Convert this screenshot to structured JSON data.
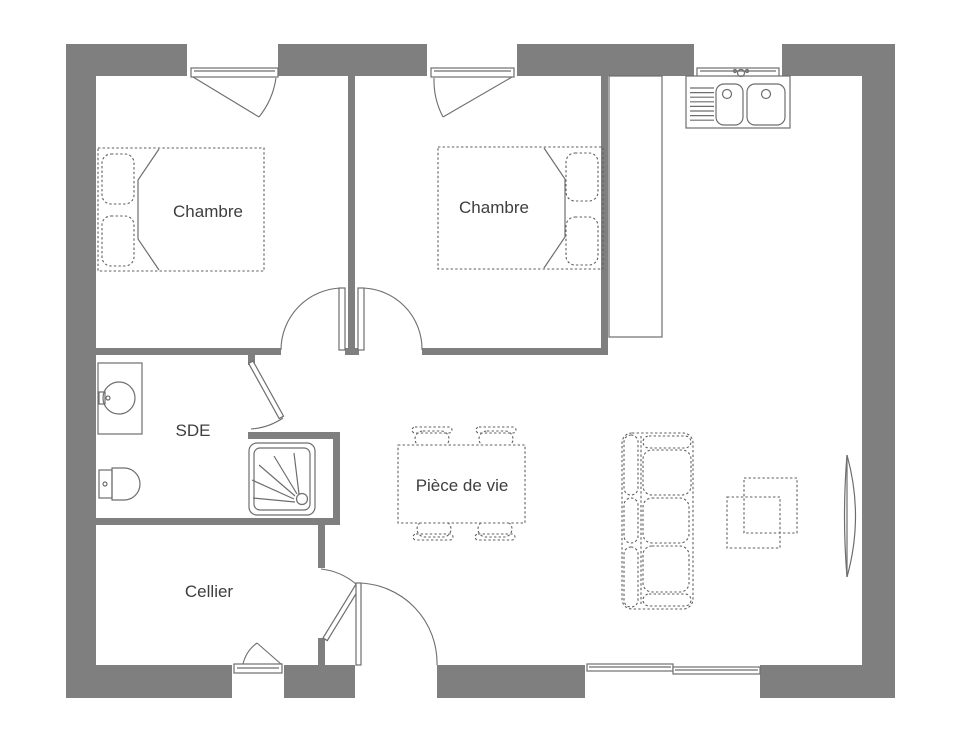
{
  "plan": {
    "rooms": [
      {
        "id": "chambre-1",
        "label": "Chambre"
      },
      {
        "id": "chambre-2",
        "label": "Chambre"
      },
      {
        "id": "sde",
        "label": "SDE"
      },
      {
        "id": "cellier",
        "label": "Cellier"
      },
      {
        "id": "piece-de-vie",
        "label": "Pièce de vie"
      }
    ],
    "fixtures": [
      "double-bed",
      "double-bed",
      "kitchen-sink",
      "kitchen-counter",
      "washbasin",
      "toilet",
      "shower",
      "dining-table",
      "chair",
      "sofa",
      "nesting-tables",
      "radiator"
    ],
    "openings": [
      "window-bedroom-1",
      "window-bedroom-2",
      "window-kitchen",
      "window-cellier",
      "sliding-bay-window",
      "door-bedroom-1",
      "door-bedroom-2",
      "door-sde",
      "door-cellier",
      "door-entrance"
    ],
    "colors": {
      "wall": "#7f7f7f",
      "line": "#6e6e6e",
      "dash": "#5f5f5f",
      "text": "#3e3e3e",
      "bg": "#ffffff"
    }
  }
}
